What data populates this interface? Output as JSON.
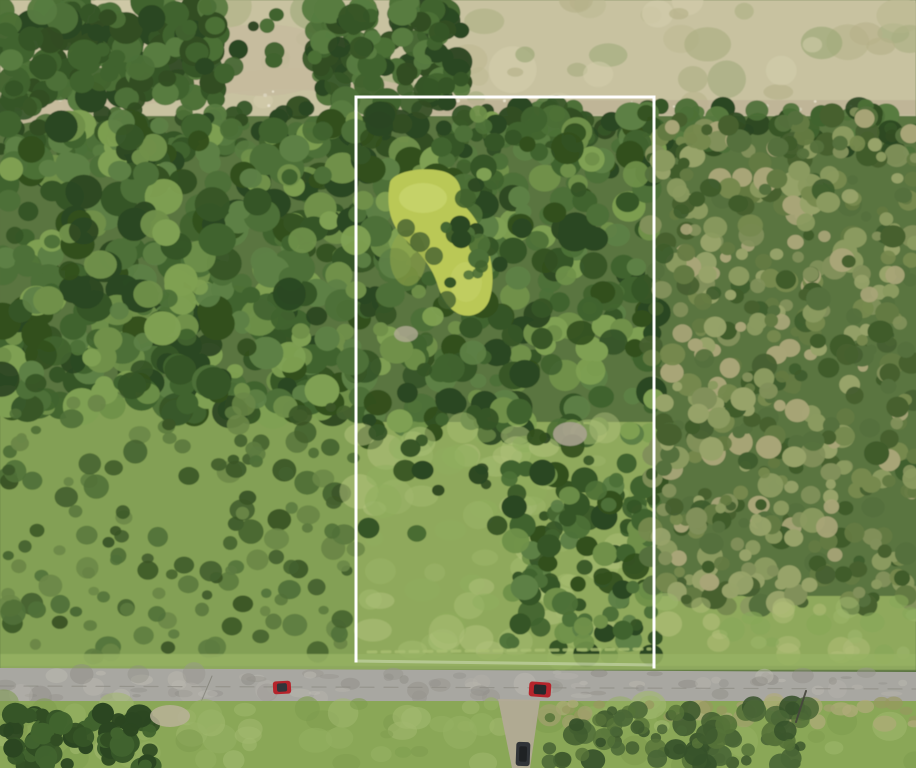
{
  "scene": {
    "width": 916,
    "height": 768,
    "kind": "aerial-drone-photo-of-wooded-land-parcel"
  },
  "key_colors": {
    "boundary_white": "#ffffff",
    "pond_algae": "#bac857",
    "road_asphalt": "#a8a7a1",
    "dry_field_tan": "#c8c2a0",
    "vehicle_red": "#b5242b",
    "vehicle_dark": "#303438"
  },
  "boundary": {
    "name": "property-boundary",
    "stroke": "#ffffff",
    "width": 3,
    "lines": [
      {
        "x1": 356,
        "y1": 97,
        "x2": 654,
        "y2": 97,
        "opacity": 1
      },
      {
        "x1": 356,
        "y1": 97,
        "x2": 356,
        "y2": 661,
        "opacity": 1
      },
      {
        "x1": 654,
        "y1": 97,
        "x2": 654,
        "y2": 667,
        "opacity": 1
      },
      {
        "x1": 356,
        "y1": 661,
        "x2": 654,
        "y2": 665,
        "opacity": 0.3
      }
    ]
  },
  "vehicles": [
    {
      "name": "red-car-on-road",
      "x": 273,
      "y": 681,
      "w": 18,
      "h": 13,
      "rot": -3,
      "body": "#b5242b",
      "top": "#33353a"
    },
    {
      "name": "red-pickup-on-road",
      "x": 529,
      "y": 682,
      "w": 22,
      "h": 15,
      "rot": 4,
      "body": "#b5242b",
      "top": "#26292b"
    },
    {
      "name": "dark-car-on-driveway",
      "x": 516,
      "y": 742,
      "w": 14,
      "h": 24,
      "rot": 2,
      "body": "#303438",
      "top": "#1f2224"
    }
  ],
  "layers": [
    {
      "kind": "rect",
      "name": "top-dry-field",
      "group": "terrain",
      "x": 0,
      "y": 0,
      "w": 916,
      "h": 140,
      "fill": "#c8c2a0"
    },
    {
      "kind": "scatter",
      "name": "field-mottle",
      "group": "terrain",
      "x": 0,
      "y": 0,
      "w": 916,
      "h": 112,
      "count": 70,
      "rmin": 8,
      "rmax": 26,
      "squish": 0.5,
      "opacity": 0.6,
      "seed": 11,
      "colors": [
        "#b6b189",
        "#a9ad80",
        "#d3cdab",
        "#9ca878",
        "#bdb992"
      ]
    },
    {
      "kind": "rect",
      "name": "forest-base",
      "group": "terrain",
      "x": 0,
      "y": 116,
      "w": 916,
      "h": 552,
      "fill": "#5a7440"
    },
    {
      "kind": "rect",
      "name": "left-shrub-base",
      "group": "terrain",
      "x": 0,
      "y": 398,
      "w": 358,
      "h": 268,
      "fill": "#83a054"
    },
    {
      "kind": "rect",
      "name": "parcel-meadow-base",
      "group": "terrain",
      "x": 356,
      "y": 422,
      "w": 298,
      "h": 244,
      "fill": "#8fa95c"
    },
    {
      "kind": "rect",
      "name": "right-grass-base",
      "group": "terrain",
      "x": 654,
      "y": 596,
      "w": 262,
      "h": 70,
      "fill": "#8fa95c"
    },
    {
      "kind": "path",
      "name": "dirt-path-top-left",
      "group": "terrain",
      "fill": "#c6bb9d",
      "opacity": 0.95,
      "d": "M0,98 C70,94 150,84 225,74 C285,66 330,64 380,80 L458,96 L458,114 C370,96 305,84 240,92 C165,102 80,112 0,128 Z"
    },
    {
      "kind": "ellipse",
      "name": "dirt-clearing-top",
      "group": "terrain",
      "cx": 262,
      "cy": 60,
      "rx": 76,
      "ry": 36,
      "fill": "#c6bb9d",
      "opacity": 0.85
    },
    {
      "kind": "rect",
      "name": "gravel-track-right",
      "group": "terrain",
      "x": 356,
      "y": 100,
      "w": 560,
      "h": 15,
      "fill": "#bdb295",
      "opacity": 0.8
    },
    {
      "kind": "scatter",
      "name": "gravel-dots-left",
      "group": "terrain",
      "x": 40,
      "y": 80,
      "w": 380,
      "h": 34,
      "count": 22,
      "rmin": 1,
      "rmax": 3,
      "squish": 0.8,
      "opacity": 0.9,
      "seed": 21,
      "colors": [
        "#e8e2cd",
        "#dcd6bf"
      ]
    },
    {
      "kind": "scatter",
      "name": "gravel-dots-right",
      "group": "terrain",
      "x": 456,
      "y": 100,
      "w": 440,
      "h": 14,
      "count": 20,
      "rmin": 1,
      "rmax": 2.5,
      "squish": 0.8,
      "opacity": 0.9,
      "seed": 22,
      "colors": [
        "#e8e2cd",
        "#d4cfb6"
      ]
    },
    {
      "kind": "scatter",
      "name": "top-left-forest",
      "group": "terrain",
      "x": 0,
      "y": 0,
      "w": 218,
      "h": 100,
      "count": 170,
      "rmin": 7,
      "rmax": 17,
      "squish": 0.85,
      "opacity": 1,
      "seed": 31,
      "colors": [
        "#2b4621",
        "#365527",
        "#41632e",
        "#4d7037",
        "#314d23",
        "#587b40"
      ]
    },
    {
      "kind": "scatter",
      "name": "top-mid-forest",
      "group": "terrain",
      "x": 315,
      "y": 0,
      "w": 148,
      "h": 104,
      "count": 120,
      "rmin": 7,
      "rmax": 16,
      "squish": 0.85,
      "opacity": 1,
      "seed": 32,
      "colors": [
        "#2b4621",
        "#365527",
        "#41632e",
        "#4d7037",
        "#314d23",
        "#587b40"
      ]
    },
    {
      "kind": "scatter",
      "name": "top-clearing-trees",
      "group": "terrain",
      "x": 205,
      "y": 5,
      "w": 125,
      "h": 75,
      "count": 10,
      "rmin": 5,
      "rmax": 11,
      "squish": 0.85,
      "opacity": 0.95,
      "seed": 33,
      "colors": [
        "#2b4621",
        "#41632e",
        "#4d7037"
      ]
    },
    {
      "kind": "scatter",
      "name": "treeline-band",
      "group": "terrain",
      "x": 0,
      "y": 106,
      "w": 916,
      "h": 48,
      "count": 190,
      "rmin": 6,
      "rmax": 14,
      "squish": 0.85,
      "opacity": 0.97,
      "seed": 34,
      "colors": [
        "#2b4621",
        "#365527",
        "#41632e",
        "#4d7037",
        "#314d23",
        "#587b40"
      ]
    },
    {
      "kind": "scatter",
      "name": "left-forest",
      "group": "terrain",
      "x": 0,
      "y": 122,
      "w": 360,
      "h": 292,
      "count": 460,
      "rmin": 8,
      "rmax": 19,
      "squish": 0.85,
      "opacity": 1,
      "seed": 35,
      "colors": [
        "#2b4621",
        "#365527",
        "#41632e",
        "#4d7037",
        "#5d8045",
        "#6f9049",
        "#7fa052",
        "#33501f"
      ]
    },
    {
      "kind": "scatter",
      "name": "left-shrub-bushes",
      "group": "terrain",
      "x": 2,
      "y": 402,
      "w": 354,
      "h": 256,
      "count": 150,
      "rmin": 5,
      "rmax": 13,
      "squish": 0.8,
      "opacity": 0.92,
      "seed": 36,
      "colors": [
        "#44612e",
        "#507038",
        "#5d7b40",
        "#3a5527",
        "#6b8747"
      ]
    },
    {
      "kind": "scatter",
      "name": "parcel-upper-forest",
      "group": "terrain",
      "x": 352,
      "y": 112,
      "w": 302,
      "h": 326,
      "count": 330,
      "rmin": 7,
      "rmax": 17,
      "squish": 0.85,
      "opacity": 1,
      "seed": 37,
      "colors": [
        "#2b4621",
        "#365527",
        "#41632e",
        "#4d7037",
        "#5d8045",
        "#6f9049",
        "#7fa052",
        "#33501f"
      ]
    },
    {
      "kind": "pond",
      "name": "algae-pond",
      "group": "terrain",
      "fill": "#bac857",
      "d": "M390,182 C394,172 420,166 442,171 C458,175 464,188 459,202 C471,210 480,224 486,243 C493,263 495,284 489,301 C484,313 471,319 459,314 C448,309 441,297 437,283 C430,262 416,250 404,238 C392,226 385,208 390,182 Z",
      "highlights": [
        {
          "cx": 423,
          "cy": 198,
          "rx": 24,
          "ry": 15,
          "fill": "#cbd56d",
          "opacity": 0.7
        },
        {
          "cx": 466,
          "cy": 282,
          "rx": 16,
          "ry": 20,
          "fill": "#c5d066",
          "opacity": 0.6
        }
      ],
      "shade": {
        "cx": 408,
        "cy": 258,
        "rx": 18,
        "ry": 28,
        "fill": "#94a748",
        "opacity": 0.55
      },
      "shadow_fill": "#45602f",
      "shadow_opacity": 0.8,
      "shadows": [
        {
          "cx": 406,
          "cy": 228,
          "r": 9
        },
        {
          "cx": 420,
          "cy": 242,
          "r": 10
        },
        {
          "cx": 434,
          "cy": 256,
          "r": 9
        },
        {
          "cx": 447,
          "cy": 300,
          "r": 9
        }
      ]
    },
    {
      "kind": "scatter",
      "name": "pond-edge-trees",
      "group": "terrain",
      "x": 446,
      "y": 180,
      "w": 44,
      "h": 110,
      "count": 16,
      "rmin": 5,
      "rmax": 11,
      "squish": 0.85,
      "opacity": 0.95,
      "seed": 38,
      "colors": [
        "#2b4621",
        "#365527",
        "#41632e",
        "#4d7037"
      ]
    },
    {
      "kind": "scatter",
      "name": "parcel-meadow-patches",
      "group": "terrain",
      "x": 358,
      "y": 426,
      "w": 294,
      "h": 232,
      "count": 80,
      "rmin": 8,
      "rmax": 20,
      "squish": 0.55,
      "opacity": 0.5,
      "seed": 39,
      "colors": [
        "#9db66b",
        "#a9bf74",
        "#8fae5e",
        "#b2c27c"
      ]
    },
    {
      "kind": "scatter",
      "name": "parcel-scattered-trees",
      "group": "terrain",
      "x": 360,
      "y": 418,
      "w": 288,
      "h": 120,
      "count": 26,
      "rmin": 5,
      "rmax": 12,
      "squish": 0.85,
      "opacity": 0.95,
      "seed": 40,
      "colors": [
        "#2b4621",
        "#365527",
        "#41632e",
        "#33501f"
      ]
    },
    {
      "kind": "scatter",
      "name": "parcel-right-trees",
      "group": "terrain",
      "x": 508,
      "y": 468,
      "w": 148,
      "h": 188,
      "count": 110,
      "rmin": 6,
      "rmax": 14,
      "squish": 0.85,
      "opacity": 1,
      "seed": 41,
      "colors": [
        "#2b4621",
        "#365527",
        "#41632e",
        "#4d7037",
        "#5d8045",
        "#6f9049",
        "#33501f"
      ]
    },
    {
      "kind": "ellipse",
      "name": "gray-rock-mound",
      "group": "terrain",
      "cx": 570,
      "cy": 434,
      "rx": 17,
      "ry": 12,
      "fill": "#a9a28f",
      "opacity": 0.9
    },
    {
      "kind": "ellipse",
      "name": "bare-soil-patch",
      "group": "terrain",
      "cx": 406,
      "cy": 334,
      "rx": 12,
      "ry": 8,
      "fill": "#b2ab95",
      "opacity": 0.8
    },
    {
      "kind": "scatter",
      "name": "right-scrub-forest",
      "group": "terrain",
      "x": 650,
      "y": 112,
      "w": 266,
      "h": 496,
      "count": 540,
      "rmin": 5,
      "rmax": 13,
      "squish": 0.85,
      "opacity": 1,
      "seed": 42,
      "colors": [
        "#55703c",
        "#647a42",
        "#76894e",
        "#8a9a5f",
        "#97a369",
        "#46602f",
        "#a8a577",
        "#3f5c2c",
        "#81905a"
      ]
    },
    {
      "kind": "scatter",
      "name": "right-grass-patches",
      "group": "terrain",
      "x": 654,
      "y": 598,
      "w": 262,
      "h": 62,
      "count": 30,
      "rmin": 6,
      "rmax": 14,
      "squish": 0.6,
      "opacity": 0.6,
      "seed": 43,
      "colors": [
        "#9db66b",
        "#87a859",
        "#b0bd78"
      ]
    },
    {
      "kind": "rect",
      "name": "roadside-verge",
      "group": "terrain",
      "x": 0,
      "y": 654,
      "w": 916,
      "h": 16,
      "fill": "#97b163",
      "opacity": 0.85
    },
    {
      "kind": "line",
      "name": "mowed-trail",
      "group": "terrain",
      "x1": 368,
      "y1": 652,
      "x2": 650,
      "y2": 649,
      "stroke": "#aabf72",
      "width": 3,
      "opacity": 0.8,
      "dash": "8 6"
    },
    {
      "kind": "path",
      "name": "paved-road",
      "group": "overlay",
      "fill": "#a8a7a1",
      "opacity": 1,
      "d": "M0,668 L916,672 L916,703 L0,701 Z"
    },
    {
      "kind": "scatter",
      "name": "road-surface-texture",
      "group": "overlay",
      "x": 0,
      "y": 672,
      "w": 916,
      "h": 26,
      "count": 90,
      "rmin": 4,
      "rmax": 12,
      "squish": 0.22,
      "opacity": 0.45,
      "seed": 44,
      "colors": [
        "#96948d",
        "#b6b4ac",
        "#8e8c85",
        "#bdbbb2"
      ]
    },
    {
      "kind": "line",
      "name": "road-crack-center",
      "group": "overlay",
      "x1": 0,
      "y1": 686,
      "x2": 916,
      "y2": 689,
      "stroke": "#8e8c84",
      "width": 1.2,
      "opacity": 0.7,
      "dash": "14 10"
    },
    {
      "kind": "line",
      "name": "road-crack-left",
      "group": "overlay",
      "x1": 212,
      "y1": 676,
      "x2": 196,
      "y2": 714,
      "stroke": "#6b6b5f",
      "width": 1,
      "opacity": 0.5,
      "dash": ""
    },
    {
      "kind": "rect",
      "name": "below-road-grass",
      "group": "overlay",
      "x": 0,
      "y": 701,
      "w": 916,
      "h": 67,
      "fill": "#8aa757"
    },
    {
      "kind": "scatter",
      "name": "below-grass-mottle",
      "group": "overlay",
      "x": 0,
      "y": 702,
      "w": 916,
      "h": 64,
      "count": 80,
      "rmin": 6,
      "rmax": 18,
      "squish": 0.6,
      "opacity": 0.55,
      "seed": 45,
      "colors": [
        "#96b163",
        "#7e9c4e",
        "#a2b96f"
      ]
    },
    {
      "kind": "scatter",
      "name": "below-road-olive-band",
      "group": "overlay",
      "x": 548,
      "y": 702,
      "w": 368,
      "h": 22,
      "count": 36,
      "rmin": 5,
      "rmax": 12,
      "squish": 0.5,
      "opacity": 0.7,
      "seed": 46,
      "colors": [
        "#a3a06f",
        "#b0ab7a",
        "#97985f"
      ]
    },
    {
      "kind": "scatter",
      "name": "bottom-left-trees",
      "group": "overlay",
      "x": 0,
      "y": 712,
      "w": 155,
      "h": 56,
      "count": 80,
      "rmin": 6,
      "rmax": 14,
      "squish": 0.85,
      "opacity": 1,
      "seed": 47,
      "colors": [
        "#2b4621",
        "#365527",
        "#41632e",
        "#314d23"
      ]
    },
    {
      "kind": "scatter",
      "name": "bottom-mid-tree-shadows",
      "group": "overlay",
      "x": 548,
      "y": 706,
      "w": 260,
      "h": 62,
      "count": 90,
      "rmin": 5,
      "rmax": 13,
      "squish": 0.85,
      "opacity": 0.85,
      "seed": 48,
      "colors": [
        "#3f5a2e",
        "#4a6636",
        "#557238",
        "#36512a"
      ]
    },
    {
      "kind": "ellipse",
      "name": "dirt-patch-below-road",
      "group": "overlay",
      "cx": 170,
      "cy": 716,
      "rx": 20,
      "ry": 11,
      "fill": "#b9b198",
      "opacity": 0.85
    },
    {
      "kind": "path",
      "name": "gravel-driveway",
      "group": "overlay",
      "fill": "#b2aa96",
      "opacity": 0.95,
      "d": "M498,699 L540,700 L530,768 L512,768 Z"
    },
    {
      "kind": "line",
      "name": "utility-pole",
      "group": "overlay",
      "x1": 806,
      "y1": 691,
      "x2": 796,
      "y2": 722,
      "stroke": "#45453c",
      "width": 2,
      "opacity": 0.9,
      "dash": ""
    }
  ]
}
